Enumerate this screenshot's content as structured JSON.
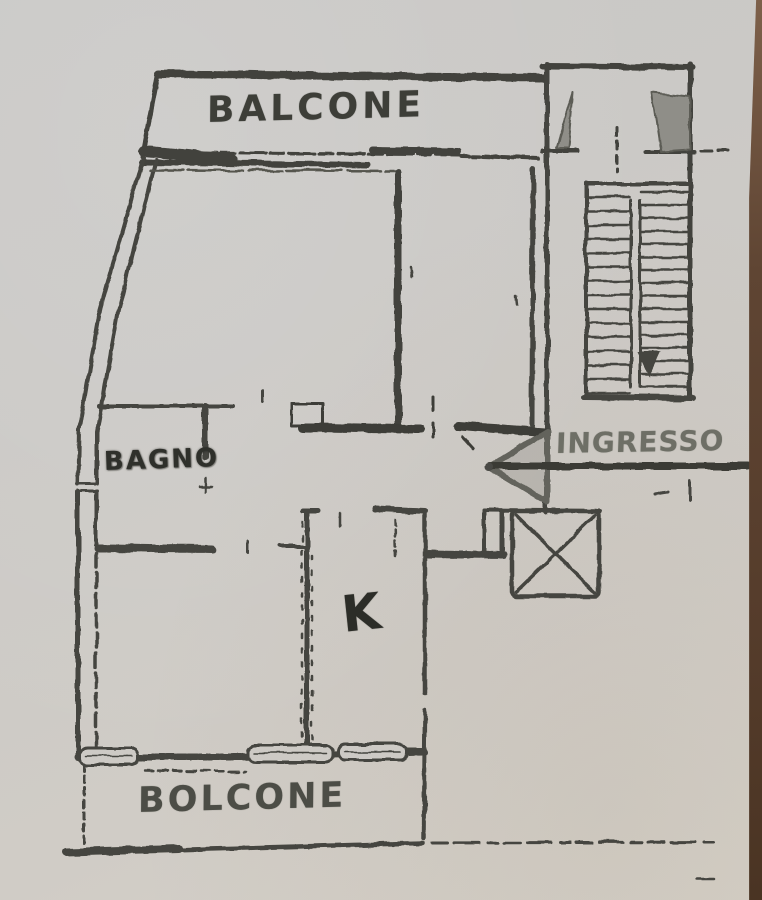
{
  "meta": {
    "title": "Scanned apartment floor plan sketch",
    "type": "floor-plan"
  },
  "labels": {
    "balcony_top": "BALCONE",
    "bathroom": "BAGNO",
    "entrance": "INGRESSO",
    "kitchen": "K",
    "balcony_bottom": "BOLCONE"
  },
  "icons": {
    "stairs_down_arrow": "triangle-down",
    "entrance_arrow": "arrow-left-with-shaft",
    "elevator": "square-with-x-diagonals",
    "windows": "rounded-rect-openings"
  },
  "colors": {
    "paper": "#cdcac5",
    "ink": "#45453f",
    "ink_dark": "#3a3a34",
    "handwriting": "#5b5c53",
    "shading": "#8f8e88",
    "photo_edge_brown": "#553c2b"
  }
}
